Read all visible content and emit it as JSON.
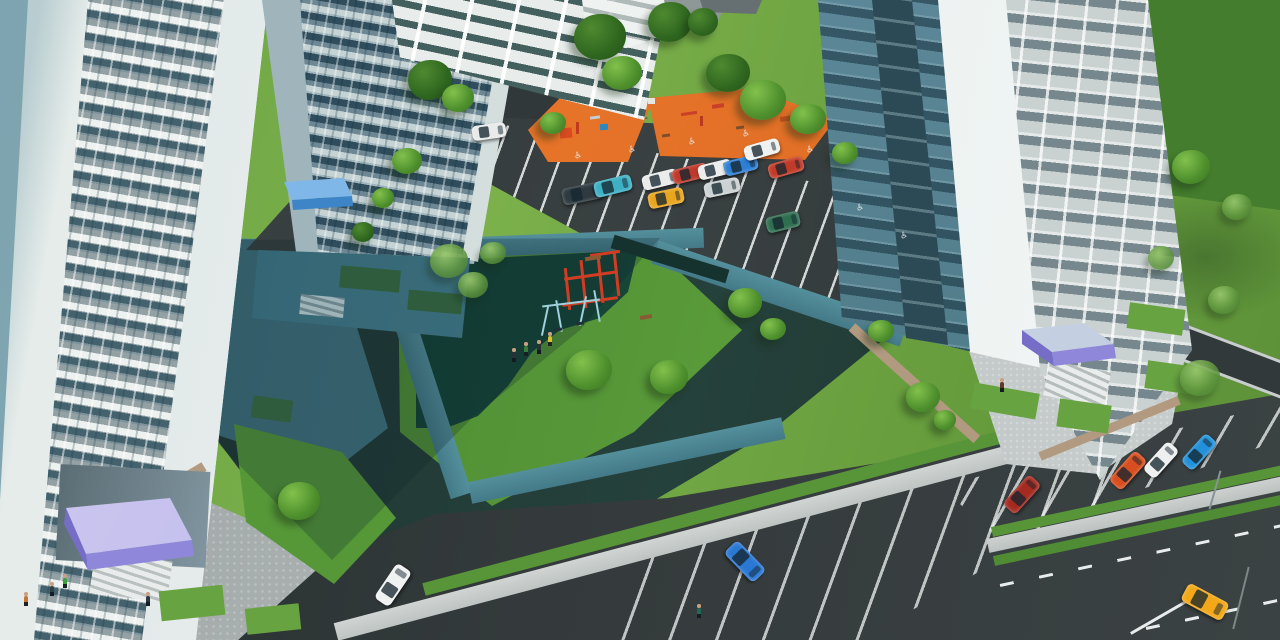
{
  "scene": {
    "type": "3d-architectural-aerial-render",
    "description": "Aerial 3D visualization of a residential complex courtyard: three light high-rise apartment towers with purple and blue entrance canopies, a multi-storey parking garage, two orange children's playgrounds with play equipment, a central green island with dark-green rubber play area, red climbing frame and light-blue swings, parking lots with cars, disabled-parking markings, sidewalks, roads with lane markings, lawns, trees and small human figures."
  },
  "palette": {
    "lawn": "#6fa943",
    "grassPatch": "#68a341",
    "forest": "#3a7026",
    "asphalt": "#35393a",
    "asphaltShadow": "#20302e",
    "rubber": "#174537",
    "orange": "#ee7c2e",
    "orangeDark": "#d96620",
    "walk": "#c4c9c7",
    "walkShadow": "#4a8492",
    "plaza": "#a4aaa9",
    "facade": "#e9efee",
    "facadeBand": "#97a3a5",
    "facadeShadow": "#587f8e",
    "glass": "#3c5f6e",
    "purple": "#8f88da",
    "blueCanopy": "#3d85c6",
    "tan": "#b29a80",
    "line": "#eef2f1",
    "climbFrame": "#d23c22",
    "swingFrame": "#9fd0dc"
  },
  "parking": {
    "accessible_symbol": "♿",
    "marking_color": "#eef2f1"
  },
  "vehicles": [
    {
      "name": "white-hatchback",
      "x": 472,
      "y": 124,
      "w": 34,
      "h": 15,
      "rot": -8,
      "color": "#e8ebea"
    },
    {
      "name": "dark-suv",
      "x": 562,
      "y": 185,
      "w": 40,
      "h": 17,
      "rot": -12,
      "color": "#2e3a40"
    },
    {
      "name": "teal-sedan",
      "x": 594,
      "y": 178,
      "w": 38,
      "h": 16,
      "rot": -14,
      "color": "#3db0c4"
    },
    {
      "name": "white-sedan",
      "x": 642,
      "y": 172,
      "w": 36,
      "h": 15,
      "rot": -14,
      "color": "#e9eceb"
    },
    {
      "name": "red-sedan",
      "x": 672,
      "y": 166,
      "w": 36,
      "h": 15,
      "rot": -14,
      "color": "#c0392b"
    },
    {
      "name": "white-coupe",
      "x": 698,
      "y": 162,
      "w": 34,
      "h": 15,
      "rot": -14,
      "color": "#eceeed"
    },
    {
      "name": "blue-hatchback",
      "x": 724,
      "y": 158,
      "w": 34,
      "h": 15,
      "rot": -14,
      "color": "#2d7fd6"
    },
    {
      "name": "white-sedan-2",
      "x": 744,
      "y": 142,
      "w": 36,
      "h": 15,
      "rot": -16,
      "color": "#eff1f0"
    },
    {
      "name": "red-sedan-2",
      "x": 768,
      "y": 160,
      "w": 36,
      "h": 15,
      "rot": -16,
      "color": "#c23a28"
    },
    {
      "name": "silver-sedan",
      "x": 704,
      "y": 180,
      "w": 36,
      "h": 15,
      "rot": -12,
      "color": "#ccd2d3"
    },
    {
      "name": "yellow-coupe",
      "x": 648,
      "y": 190,
      "w": 36,
      "h": 16,
      "rot": -12,
      "color": "#eaa51e"
    },
    {
      "name": "green-minivan",
      "x": 766,
      "y": 214,
      "w": 34,
      "h": 16,
      "rot": -14,
      "color": "#2f6f50"
    },
    {
      "name": "darkred-car-parked",
      "x": 1002,
      "y": 486,
      "w": 40,
      "h": 17,
      "rot": -48,
      "color": "#a52a20"
    },
    {
      "name": "orange-car-parked",
      "x": 1108,
      "y": 462,
      "w": 40,
      "h": 17,
      "rot": -48,
      "color": "#d84e1e"
    },
    {
      "name": "white-car-parked",
      "x": 1142,
      "y": 452,
      "w": 38,
      "h": 16,
      "rot": -48,
      "color": "#eef0ef"
    },
    {
      "name": "blue-car-parked",
      "x": 1180,
      "y": 444,
      "w": 38,
      "h": 16,
      "rot": -48,
      "color": "#2191d9"
    },
    {
      "name": "blue-minivan",
      "x": 724,
      "y": 552,
      "w": 42,
      "h": 19,
      "rot": 46,
      "color": "#2b78d4"
    },
    {
      "name": "white-car-driving",
      "x": 372,
      "y": 576,
      "w": 42,
      "h": 18,
      "rot": -56,
      "color": "#f0f2f1"
    },
    {
      "name": "yellow-sportscar",
      "x": 1182,
      "y": 592,
      "w": 46,
      "h": 20,
      "rot": 28,
      "color": "#f2a818"
    }
  ],
  "trees": [
    {
      "x": 408,
      "y": 60,
      "w": 44,
      "h": 40,
      "t": "dark"
    },
    {
      "x": 442,
      "y": 84,
      "w": 32,
      "h": 28,
      "t": "bright"
    },
    {
      "x": 574,
      "y": 14,
      "w": 52,
      "h": 46,
      "t": "dark"
    },
    {
      "x": 602,
      "y": 56,
      "w": 40,
      "h": 34,
      "t": "bright"
    },
    {
      "x": 648,
      "y": 2,
      "w": 44,
      "h": 40,
      "t": "dark"
    },
    {
      "x": 688,
      "y": 8,
      "w": 30,
      "h": 28,
      "t": "dark"
    },
    {
      "x": 540,
      "y": 112,
      "w": 26,
      "h": 22,
      "t": "bright"
    },
    {
      "x": 706,
      "y": 54,
      "w": 44,
      "h": 38,
      "t": "dark"
    },
    {
      "x": 740,
      "y": 80,
      "w": 46,
      "h": 40,
      "t": "bright"
    },
    {
      "x": 790,
      "y": 104,
      "w": 36,
      "h": 30,
      "t": "bright"
    },
    {
      "x": 832,
      "y": 142,
      "w": 26,
      "h": 22,
      "t": "bright"
    },
    {
      "x": 392,
      "y": 148,
      "w": 30,
      "h": 26,
      "t": "bright"
    },
    {
      "x": 372,
      "y": 188,
      "w": 22,
      "h": 20,
      "t": "bright"
    },
    {
      "x": 352,
      "y": 222,
      "w": 22,
      "h": 20,
      "t": "dark"
    },
    {
      "x": 430,
      "y": 244,
      "w": 38,
      "h": 34,
      "t": "birch"
    },
    {
      "x": 458,
      "y": 272,
      "w": 30,
      "h": 26,
      "t": "birch"
    },
    {
      "x": 480,
      "y": 242,
      "w": 26,
      "h": 22,
      "t": "birch"
    },
    {
      "x": 566,
      "y": 350,
      "w": 46,
      "h": 40,
      "t": "bright"
    },
    {
      "x": 650,
      "y": 360,
      "w": 38,
      "h": 34,
      "t": "bright"
    },
    {
      "x": 728,
      "y": 288,
      "w": 34,
      "h": 30,
      "t": "bright"
    },
    {
      "x": 760,
      "y": 318,
      "w": 26,
      "h": 22,
      "t": "bright"
    },
    {
      "x": 868,
      "y": 320,
      "w": 26,
      "h": 22,
      "t": "bright"
    },
    {
      "x": 906,
      "y": 382,
      "w": 34,
      "h": 30,
      "t": "bright"
    },
    {
      "x": 934,
      "y": 410,
      "w": 22,
      "h": 20,
      "t": "bright"
    },
    {
      "x": 1172,
      "y": 150,
      "w": 38,
      "h": 34,
      "t": "bright"
    },
    {
      "x": 1222,
      "y": 194,
      "w": 30,
      "h": 26,
      "t": "birch"
    },
    {
      "x": 1148,
      "y": 246,
      "w": 26,
      "h": 24,
      "t": "birch"
    },
    {
      "x": 1208,
      "y": 286,
      "w": 32,
      "h": 28,
      "t": "birch"
    },
    {
      "x": 1180,
      "y": 360,
      "w": 40,
      "h": 36,
      "t": "birch"
    },
    {
      "x": 278,
      "y": 482,
      "w": 42,
      "h": 38,
      "t": "bright"
    }
  ],
  "people": [
    {
      "name": "pedestrian",
      "x": 24,
      "y": 596,
      "c": "#c07838"
    },
    {
      "name": "pedestrian",
      "x": 50,
      "y": 586,
      "c": "#304048"
    },
    {
      "name": "pedestrian",
      "x": 63,
      "y": 578,
      "c": "#3aa040"
    },
    {
      "name": "pedestrian",
      "x": 146,
      "y": 596,
      "c": "#2a3640"
    },
    {
      "name": "pedestrian",
      "x": 512,
      "y": 352,
      "c": "#283038"
    },
    {
      "name": "pedestrian",
      "x": 524,
      "y": 346,
      "c": "#3a7a3a"
    },
    {
      "name": "pedestrian",
      "x": 537,
      "y": 344,
      "c": "#283038"
    },
    {
      "name": "pedestrian",
      "x": 548,
      "y": 336,
      "c": "#d8c030"
    },
    {
      "name": "pedestrian",
      "x": 1000,
      "y": 382,
      "c": "#603828"
    },
    {
      "name": "pedestrian",
      "x": 697,
      "y": 608,
      "c": "#206858"
    }
  ],
  "accessible_markings": [
    {
      "x": 574,
      "y": 152
    },
    {
      "x": 628,
      "y": 146
    },
    {
      "x": 688,
      "y": 138
    },
    {
      "x": 742,
      "y": 130
    },
    {
      "x": 806,
      "y": 146
    },
    {
      "x": 856,
      "y": 204
    },
    {
      "x": 900,
      "y": 232
    }
  ],
  "grass_patches": [
    {
      "x": 1128,
      "y": 306,
      "w": 56,
      "h": 26,
      "rot": 8
    },
    {
      "x": 1146,
      "y": 364,
      "w": 56,
      "h": 28,
      "rot": 8
    },
    {
      "x": 1058,
      "y": 402,
      "w": 52,
      "h": 28,
      "rot": 8
    },
    {
      "x": 972,
      "y": 388,
      "w": 66,
      "h": 26,
      "rot": 10
    },
    {
      "x": 160,
      "y": 588,
      "w": 64,
      "h": 30,
      "rot": -6
    },
    {
      "x": 246,
      "y": 606,
      "w": 54,
      "h": 26,
      "rot": -6
    },
    {
      "x": 340,
      "y": 268,
      "w": 60,
      "h": 22,
      "rot": 5,
      "c": "#2e5c3c"
    },
    {
      "x": 408,
      "y": 292,
      "w": 54,
      "h": 20,
      "rot": 5,
      "c": "#2e5c3c"
    },
    {
      "x": 252,
      "y": 398,
      "w": 40,
      "h": 22,
      "rot": 8,
      "c": "#2e5c3c"
    }
  ],
  "equipment": [
    {
      "name": "planter",
      "x": 610,
      "y": 252,
      "w": 120,
      "h": 14,
      "rot": 17,
      "c": "#16322e"
    },
    {
      "name": "climb-bar",
      "x": 566,
      "y": 268,
      "w": 3,
      "h": 42,
      "rot": -6,
      "c": "#d23c22"
    },
    {
      "name": "climb-bar",
      "x": 582,
      "y": 260,
      "w": 3,
      "h": 48,
      "rot": -6,
      "c": "#d23c22"
    },
    {
      "name": "climb-bar",
      "x": 599,
      "y": 255,
      "w": 3,
      "h": 48,
      "rot": -6,
      "c": "#d23c22"
    },
    {
      "name": "climb-bar",
      "x": 615,
      "y": 252,
      "w": 3,
      "h": 44,
      "rot": -6,
      "c": "#d23c22"
    },
    {
      "name": "climb-bar",
      "x": 564,
      "y": 274,
      "w": 54,
      "h": 3,
      "rot": -8,
      "c": "#d23c22"
    },
    {
      "name": "climb-bar",
      "x": 562,
      "y": 300,
      "w": 56,
      "h": 3,
      "rot": -8,
      "c": "#d23c22"
    },
    {
      "name": "climb-bar",
      "x": 590,
      "y": 252,
      "w": 30,
      "h": 3,
      "rot": -8,
      "c": "#d23c22"
    },
    {
      "name": "swing-leg",
      "x": 544,
      "y": 306,
      "w": 2,
      "h": 30,
      "rot": 12,
      "c": "#9fd0dc"
    },
    {
      "name": "swing-leg",
      "x": 558,
      "y": 300,
      "w": 2,
      "h": 32,
      "rot": -10,
      "c": "#9fd0dc"
    },
    {
      "name": "swing-leg",
      "x": 582,
      "y": 296,
      "w": 2,
      "h": 30,
      "rot": 12,
      "c": "#9fd0dc"
    },
    {
      "name": "swing-leg",
      "x": 596,
      "y": 290,
      "w": 2,
      "h": 32,
      "rot": -10,
      "c": "#9fd0dc"
    },
    {
      "name": "swing-bar",
      "x": 542,
      "y": 302,
      "w": 58,
      "h": 2,
      "rot": -7,
      "c": "#9fd0dc"
    },
    {
      "name": "swing-seat",
      "x": 554,
      "y": 328,
      "w": 8,
      "h": 3,
      "rot": -8,
      "c": "#203038"
    },
    {
      "name": "swing-seat",
      "x": 576,
      "y": 322,
      "w": 8,
      "h": 3,
      "rot": -8,
      "c": "#203038"
    },
    {
      "name": "bench",
      "x": 585,
      "y": 256,
      "w": 16,
      "h": 4,
      "rot": -10,
      "c": "#8a5a32"
    },
    {
      "name": "bench",
      "x": 640,
      "y": 315,
      "w": 12,
      "h": 4,
      "rot": -10,
      "c": "#8a5a32"
    },
    {
      "name": "play-structure",
      "x": 560,
      "y": 128,
      "w": 12,
      "h": 10,
      "rot": -5,
      "c": "#d84a20"
    },
    {
      "name": "play-structure",
      "x": 576,
      "y": 122,
      "w": 3,
      "h": 12,
      "rot": 0,
      "c": "#c03820"
    },
    {
      "name": "play-structure",
      "x": 590,
      "y": 116,
      "w": 10,
      "h": 3,
      "rot": -8,
      "c": "#c8ccd0"
    },
    {
      "name": "play-structure",
      "x": 600,
      "y": 124,
      "w": 8,
      "h": 6,
      "rot": -5,
      "c": "#2a88c0"
    },
    {
      "name": "sandbox-umbrella",
      "x": 648,
      "y": 98,
      "w": 7,
      "h": 6,
      "rot": 0,
      "c": "#e8e6e0"
    },
    {
      "name": "play-structure",
      "x": 681,
      "y": 112,
      "w": 16,
      "h": 3,
      "rot": -8,
      "c": "#c84028"
    },
    {
      "name": "play-structure",
      "x": 700,
      "y": 116,
      "w": 3,
      "h": 10,
      "rot": 0,
      "c": "#b83820"
    },
    {
      "name": "play-structure",
      "x": 712,
      "y": 104,
      "w": 12,
      "h": 4,
      "rot": -8,
      "c": "#c84028"
    },
    {
      "name": "play-structure",
      "x": 756,
      "y": 96,
      "w": 9,
      "h": 8,
      "rot": -5,
      "c": "#c87828"
    },
    {
      "name": "play-structure",
      "x": 780,
      "y": 116,
      "w": 14,
      "h": 5,
      "rot": -8,
      "c": "#c05020"
    },
    {
      "name": "play-structure",
      "x": 802,
      "y": 128,
      "w": 10,
      "h": 4,
      "rot": -8,
      "c": "#d6d8d8"
    },
    {
      "name": "bench",
      "x": 662,
      "y": 134,
      "w": 8,
      "h": 3,
      "rot": -8,
      "c": "#7a4f2e"
    },
    {
      "name": "bench",
      "x": 736,
      "y": 126,
      "w": 8,
      "h": 3,
      "rot": -8,
      "c": "#7a4f2e"
    },
    {
      "name": "street-light",
      "x": 1214,
      "y": 470,
      "w": 2,
      "h": 40,
      "rot": 16,
      "c": "#8a9296"
    },
    {
      "name": "street-light",
      "x": 1240,
      "y": 566,
      "w": 2,
      "h": 64,
      "rot": 14,
      "c": "#7d8689"
    }
  ]
}
